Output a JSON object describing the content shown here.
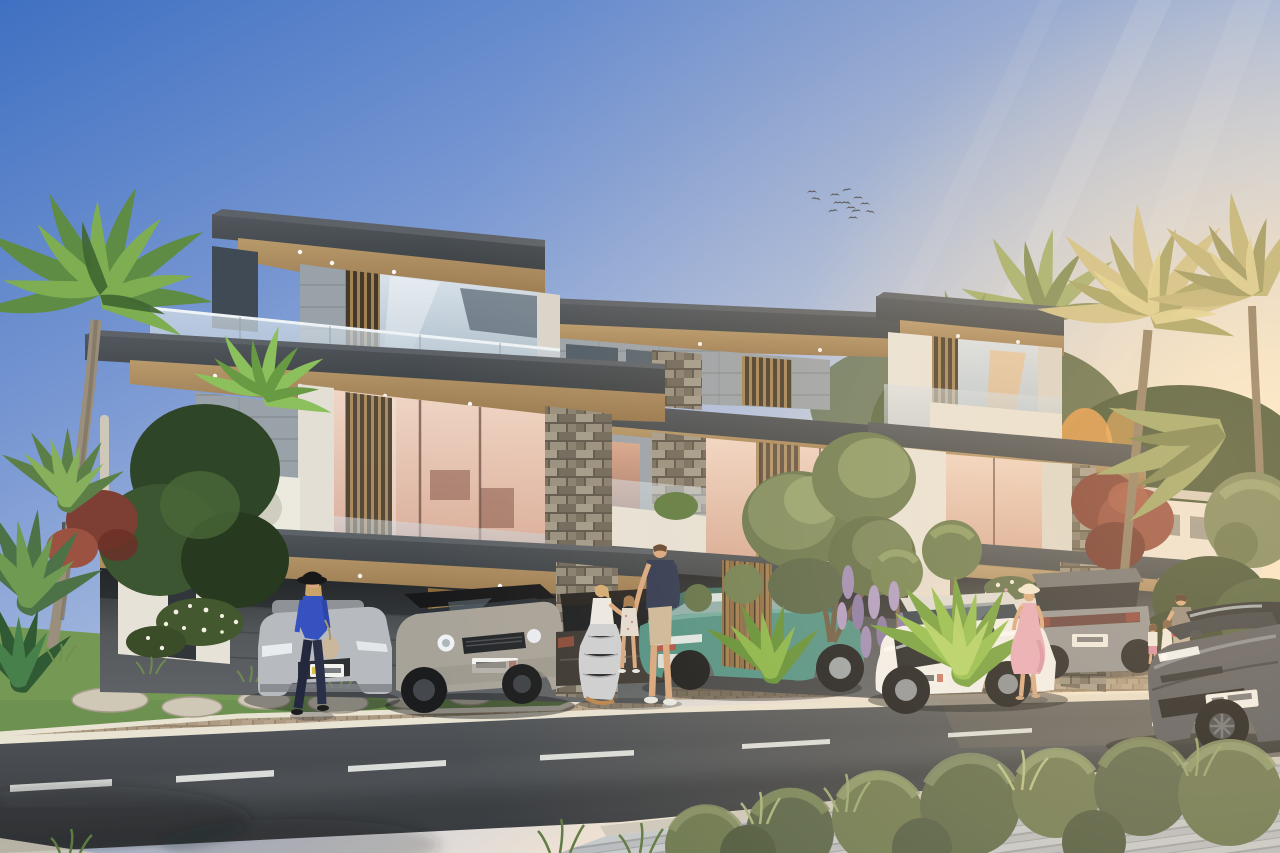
{
  "scene": {
    "type": "photorealistic architectural rendering",
    "description": "Sunset street view of a modern three-storey townhouse villa block with carports, luxury cars, pedestrians, palm trees and landscaped sidewalks",
    "time_of_day": "golden hour / sunset",
    "weather": "clear",
    "text_visible": "none (license plates present but illegible)"
  },
  "palette": {
    "sky-top": "#3f70c2",
    "sky-mid": "#b9c8e4",
    "sky-warm": "#f3e4d1",
    "sun-glow": "#fff3d8",
    "fascia-dark": "#3c4145",
    "soffit-wood": "#b89a6c",
    "wall-white": "#e9e5dc",
    "wall-grey": "#9aa2a9",
    "stone-grey": "#8f897c",
    "louver-wood": "#a28354",
    "glass-cool": "#aebfcc",
    "glass-warm": "#d8ab97",
    "paver-tan": "#b4a28b",
    "curb-white": "#e9e3d3",
    "road-asphalt": "#45494d",
    "lane-marking": "#eef0ec",
    "sidewalk-grey": "#c3c7ca",
    "grass-green": "#6d9150",
    "foliage-dark": "#31482c",
    "foliage-olive": "#74855c",
    "palm-green": "#5f8c44",
    "palm-golden": "#cfc185",
    "tree-red": "#7d3f33",
    "wisteria-purple": "#9b8ab8",
    "car-silver": "#b7babe",
    "car-landrover-grey": "#a8a399",
    "car-dark-suv": "#3a3733",
    "car-teal": "#4f9185",
    "car-white": "#f2f2f0",
    "car-grey-suv": "#8f9193",
    "car-tesla-grey": "#53575e",
    "skin": "#d9a77f",
    "outfit-blue": "#3552c0",
    "outfit-navy": "#2c3550",
    "dress-pink": "#e8a9ba",
    "bird-dark": "#4a4f55"
  },
  "sky": {
    "gradient": [
      "#3f70c2",
      "#7f9cd4",
      "#c3cfe6",
      "#f3e4d1"
    ],
    "sun": {
      "position_px": {
        "x": 1258,
        "y": 445
      },
      "glow_color": "#fff3d8"
    },
    "light_rays": 3,
    "cloud_wisps": 2,
    "birds": {
      "count": 13,
      "area_px": {
        "x": 808,
        "y": 186,
        "w": 70,
        "h": 36
      }
    }
  },
  "architecture": {
    "style": "contemporary flat-roof villas with deep cantilevered eaves",
    "storeys": 3,
    "units_visible": 3,
    "materials": [
      "charcoal fascia slabs",
      "warm timber soffits with recessed downlights",
      "off-white stucco",
      "grey wall panels",
      "stacked stone piers",
      "vertical timber louvres",
      "frameless glass balustrades",
      "floor-to-ceiling glazing with warm interiors"
    ],
    "features": [
      "roof terraces",
      "white planter boxes",
      "carports with stone columns",
      "timber slat screens"
    ]
  },
  "vehicles": [
    {
      "name": "silver-sedan",
      "type": "sedan",
      "view": "front",
      "color": "#b7babe",
      "plate": "illegible"
    },
    {
      "name": "landrover-discovery",
      "type": "SUV",
      "view": "front-three-quarter",
      "color": "#a8a399",
      "roof": "black",
      "plate": "illegible"
    },
    {
      "name": "dark-suv",
      "type": "SUV",
      "view": "rear",
      "color": "#3a3733"
    },
    {
      "name": "teal-hatchback",
      "type": "crossover",
      "view": "rear-three-quarter",
      "color": "#4f9185"
    },
    {
      "name": "white-mazda-cx5",
      "type": "SUV",
      "view": "front-three-quarter",
      "color": "#f2f2f0",
      "plate": "illegible"
    },
    {
      "name": "grey-suv",
      "type": "SUV",
      "view": "rear-three-quarter",
      "color": "#8f9193",
      "plate": "illegible"
    },
    {
      "name": "tesla-model-s",
      "type": "sedan",
      "view": "front-three-quarter",
      "color": "#53575e",
      "location": "driving on road",
      "plate": "illegible"
    }
  ],
  "people": [
    {
      "name": "woman-walking",
      "clothing": "black wide-brim hat, royal blue blouse, navy trousers, beige shoulder bag"
    },
    {
      "name": "man-standing",
      "clothing": "navy t-shirt, beige shorts, white sneakers"
    },
    {
      "name": "woman-kneeling",
      "clothing": "white tank top, grey patterned skirt"
    },
    {
      "name": "girl-child",
      "clothing": "pale floral dress"
    },
    {
      "name": "woman-pink-dress",
      "clothing": "white sun hat, pink flowing dress"
    },
    {
      "name": "man-with-children",
      "clothing": "taupe t-shirt, beige shorts",
      "children": 2
    }
  ],
  "vegetation": [
    "green fan palms (left)",
    "backlit golden palms (right)",
    "red japanese maple",
    "clipped topiary trees and topiary balls",
    "purple wisteria",
    "yucca and tropical shrubs",
    "round hedge bushes along foreground sidewalk",
    "ornamental grasses",
    "white flowering groundcover"
  ],
  "ground": {
    "road": {
      "surface": "asphalt",
      "marking": "white dashed centre line",
      "dashes": 7
    },
    "curb": "light stone curb",
    "sidewalk_near": "grey plank pavers (bottom right)",
    "sidewalk_far": "tan brick pavers and driveways",
    "verge": "lawn with flagstone stepping stones (bottom left)"
  },
  "lighting": {
    "golden_hour_from_right": true,
    "long_soft_shadows": true
  }
}
